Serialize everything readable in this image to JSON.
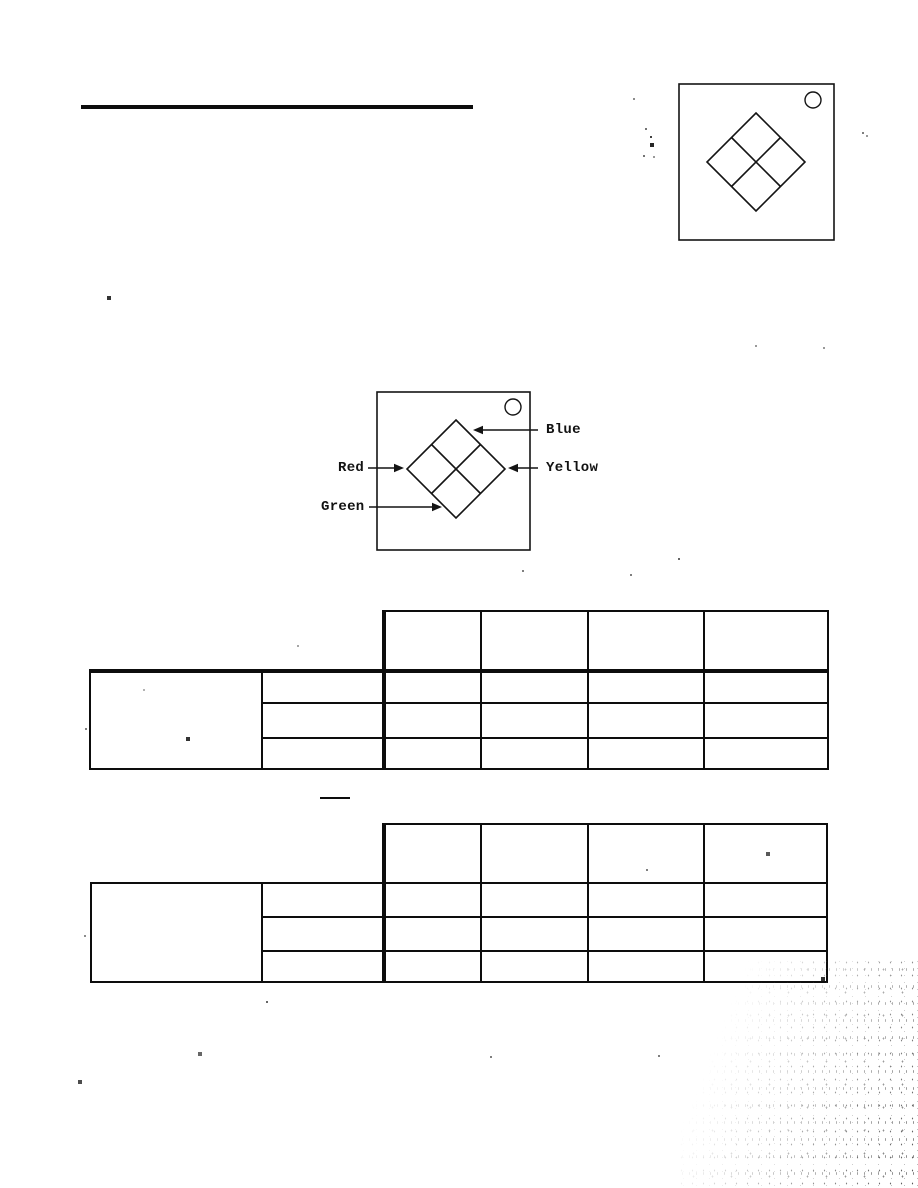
{
  "page": {
    "paper_color": "#ffffff",
    "ink_color": "#111111"
  },
  "labeled_figure": {
    "labels": {
      "blue": "Blue",
      "yellow": "Yellow",
      "red": "Red",
      "green": "Green"
    }
  },
  "tables": {
    "table1": {
      "header_columns": 4,
      "body_rows": 3,
      "left_span_rows": 3,
      "all_cells_blank": true
    },
    "table2": {
      "header_columns": 4,
      "body_rows": 3,
      "left_span_rows": 3,
      "all_cells_blank": true
    }
  }
}
